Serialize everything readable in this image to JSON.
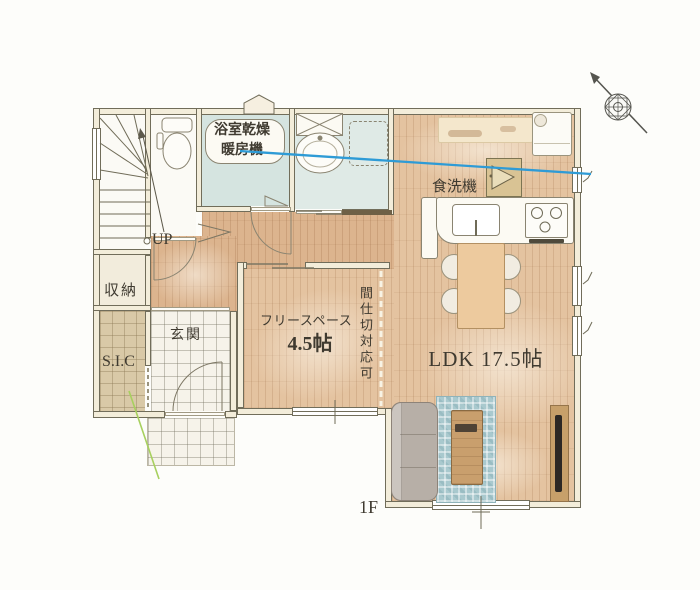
{
  "floorplan": {
    "floor_label": "1F",
    "labels": {
      "bathroom_unit": "浴室乾燥暖房機",
      "dishwasher": "食洗機",
      "up": "UP",
      "storage": "収納",
      "shoe_closet": "S.I.C",
      "entrance": "玄関",
      "free_space": "フリースペース",
      "free_space_size": "4.5帖",
      "partition_note": "間仕切対応可",
      "ldk": "LDK 17.5帖"
    },
    "colors": {
      "wood_floor": "#e4c3a0",
      "hall_wood_floor": "#dcb48e",
      "bath_floor": "#d5e4e0",
      "tile_beige": "#d9c9a7",
      "tile_white": "#f6f3ea",
      "wall_line": "#716d5a",
      "rug_blue": "#a9c9ce",
      "annotation_blue": "#2e9bd6",
      "annotation_green": "#a7d05e",
      "text": "#3f3a30"
    },
    "compass": {
      "icon": "compass-rose",
      "pointing": "north-west"
    }
  }
}
